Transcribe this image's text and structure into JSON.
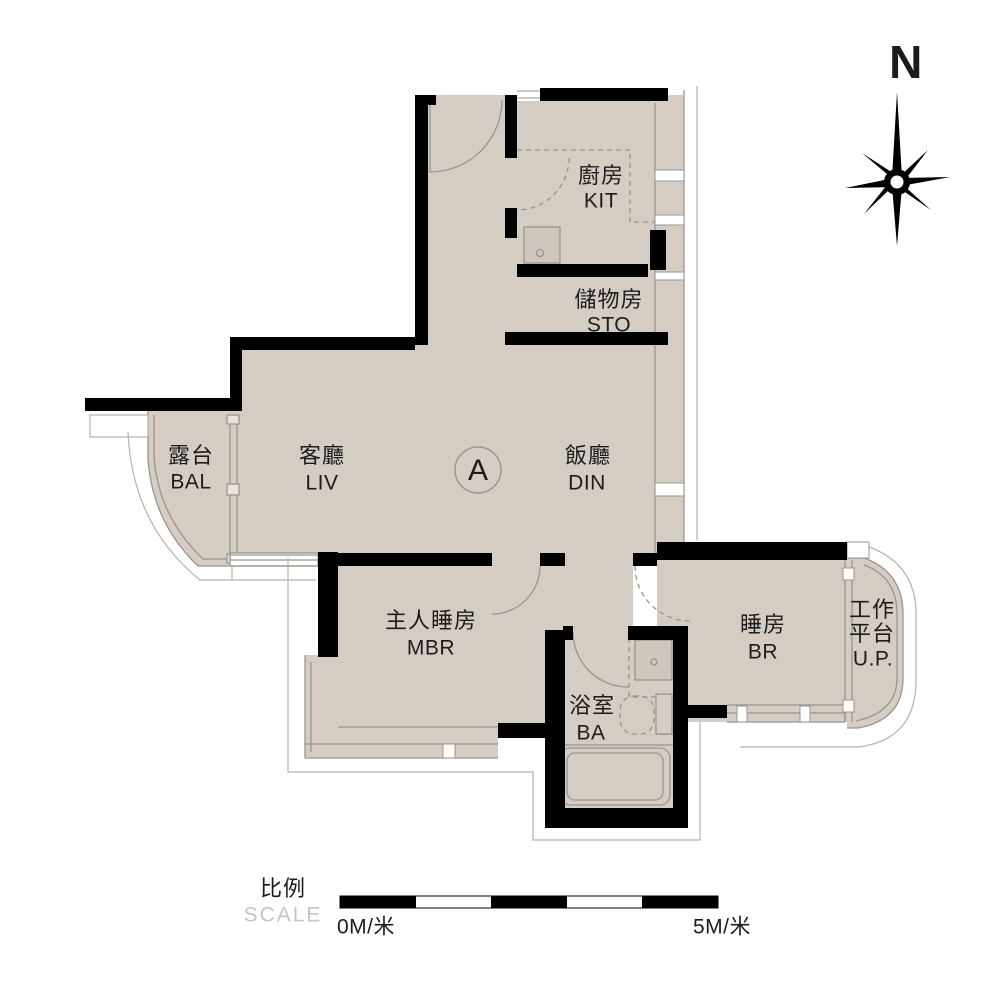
{
  "compass": {
    "north_label": "N"
  },
  "unit": {
    "label": "A"
  },
  "rooms": {
    "kitchen": {
      "zh": "廚房",
      "en": "KIT"
    },
    "storage": {
      "zh": "儲物房",
      "en": "STO"
    },
    "balcony": {
      "zh": "露台",
      "en": "BAL"
    },
    "living": {
      "zh": "客廳",
      "en": "LIV"
    },
    "dining": {
      "zh": "飯廳",
      "en": "DIN"
    },
    "master_bedroom": {
      "zh": "主人睡房",
      "en": "MBR"
    },
    "bathroom": {
      "zh": "浴室",
      "en": "BA"
    },
    "bedroom": {
      "zh": "睡房",
      "en": "BR"
    },
    "utility_platform": {
      "zh_line1": "工作",
      "zh_line2": "平台",
      "en": "U.P."
    }
  },
  "scale_bar": {
    "zh": "比例",
    "en": "SCALE",
    "start_label": "0M/米",
    "end_label": "5M/米"
  },
  "colors": {
    "floor": "#d5ccc4",
    "wall": "#000000",
    "thin_line": "#9a948e",
    "site_line": "#b7b2ac",
    "fixture_fill": "#cfc6be",
    "text": "#1c1c1c",
    "scale_muted": "#c8c4bf"
  }
}
